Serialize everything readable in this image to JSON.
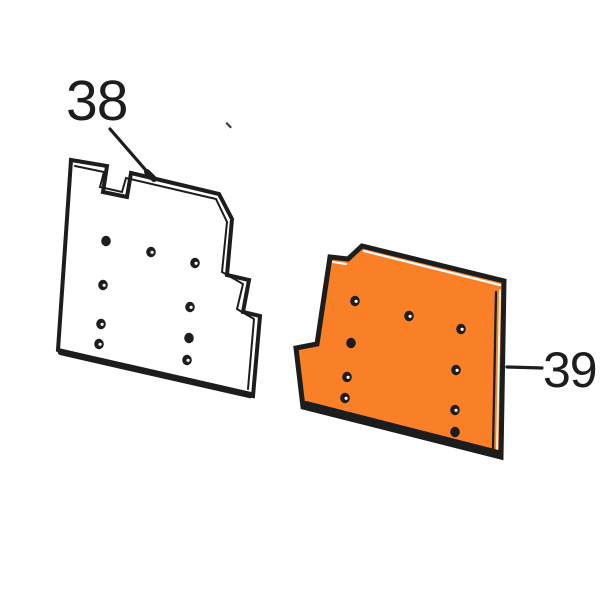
{
  "figure": {
    "type": "exploded-parts-diagram",
    "background": "#ffffff",
    "line_color": "#1d1d1d",
    "accent_fill": "#FA8028",
    "gap_color": "#ffffff",
    "labels": [
      {
        "text": "38",
        "part": "panel-38"
      },
      {
        "text": "39",
        "part": "panel-39"
      }
    ],
    "leaders": [
      {
        "for": "38",
        "x1": 110,
        "y1": 129,
        "x2": 150,
        "y2": 175,
        "width": 3.2
      },
      {
        "for": "38-tip",
        "x1": 147,
        "y1": 172,
        "x2": 154,
        "y2": 179,
        "width": 6
      },
      {
        "for": "39",
        "x1": 507,
        "y1": 367,
        "x2": 542,
        "y2": 368,
        "width": 3.2
      }
    ],
    "panels": [
      {
        "id": "panel-38",
        "fill": "#ffffff",
        "stroke_width": 4,
        "outline": [
          [
            71,
            160
          ],
          [
            107,
            166
          ],
          [
            103,
            192
          ],
          [
            127,
            197
          ],
          [
            131,
            173
          ],
          [
            219,
            194
          ],
          [
            232,
            219
          ],
          [
            227,
            275
          ],
          [
            249,
            280
          ],
          [
            243,
            312
          ],
          [
            260,
            316
          ],
          [
            253,
            396
          ],
          [
            58,
            350
          ]
        ],
        "detail_lines": [
          {
            "color": "#1d1d1d",
            "width": 2,
            "points": [
              [
                75,
                166
              ],
              [
                104,
                172
              ],
              [
                100,
                187
              ],
              [
                122,
                192
              ],
              [
                126,
                178
              ],
              [
                216,
                199
              ],
              [
                227,
                222
              ],
              [
                222,
                272
              ],
              [
                243,
                284
              ],
              [
                237,
                309
              ],
              [
                254,
                319
              ],
              [
                248,
                389
              ]
            ]
          },
          {
            "color": "#1d1d1d",
            "width": 6.5,
            "points": [
              [
                61,
                352
              ],
              [
                250,
                395
              ]
            ]
          }
        ],
        "holes": [
          {
            "x": 106,
            "y": 241,
            "style": "solid"
          },
          {
            "x": 151,
            "y": 252,
            "style": "open"
          },
          {
            "x": 195,
            "y": 263,
            "style": "open"
          },
          {
            "x": 103,
            "y": 285,
            "style": "open"
          },
          {
            "x": 190,
            "y": 307,
            "style": "open"
          },
          {
            "x": 101,
            "y": 324,
            "style": "open"
          },
          {
            "x": 99,
            "y": 344,
            "style": "open"
          },
          {
            "x": 189,
            "y": 338,
            "style": "solid"
          },
          {
            "x": 187,
            "y": 360,
            "style": "open"
          }
        ]
      },
      {
        "id": "panel-39",
        "fill": "#FA8028",
        "stroke_width": 5,
        "outline": [
          [
            330,
            257
          ],
          [
            348,
            259
          ],
          [
            362,
            246
          ],
          [
            504,
            281
          ],
          [
            501,
            457
          ],
          [
            303,
            407
          ],
          [
            296,
            348
          ],
          [
            317,
            344
          ]
        ],
        "detail_lines": [
          {
            "color": "#ffffff",
            "width": 2,
            "points": [
              [
                333,
                262
              ],
              [
                346,
                264
              ]
            ]
          },
          {
            "color": "#ffffff",
            "width": 2.2,
            "points": [
              [
                364,
                251
              ],
              [
                500,
                285
              ]
            ]
          },
          {
            "color": "#ffffff",
            "width": 1.8,
            "points": [
              [
                500,
                290
              ],
              [
                497,
                450
              ]
            ]
          },
          {
            "color": "#1d1d1d",
            "width": 2.3,
            "points": [
              [
                496,
                292
              ],
              [
                493,
                449
              ]
            ]
          },
          {
            "color": "#1d1d1d",
            "width": 8,
            "points": [
              [
                306,
                405
              ],
              [
                498,
                454
              ]
            ]
          }
        ],
        "holes": [
          {
            "x": 355,
            "y": 301,
            "style": "open"
          },
          {
            "x": 409,
            "y": 316,
            "style": "open"
          },
          {
            "x": 461,
            "y": 329,
            "style": "open"
          },
          {
            "x": 351,
            "y": 343,
            "style": "solid"
          },
          {
            "x": 456,
            "y": 370,
            "style": "open"
          },
          {
            "x": 347,
            "y": 377,
            "style": "open"
          },
          {
            "x": 455,
            "y": 410,
            "style": "open"
          },
          {
            "x": 345,
            "y": 398,
            "style": "open"
          },
          {
            "x": 455,
            "y": 432,
            "style": "solid"
          }
        ]
      }
    ],
    "speck": {
      "x": 227,
      "y": 122
    }
  }
}
